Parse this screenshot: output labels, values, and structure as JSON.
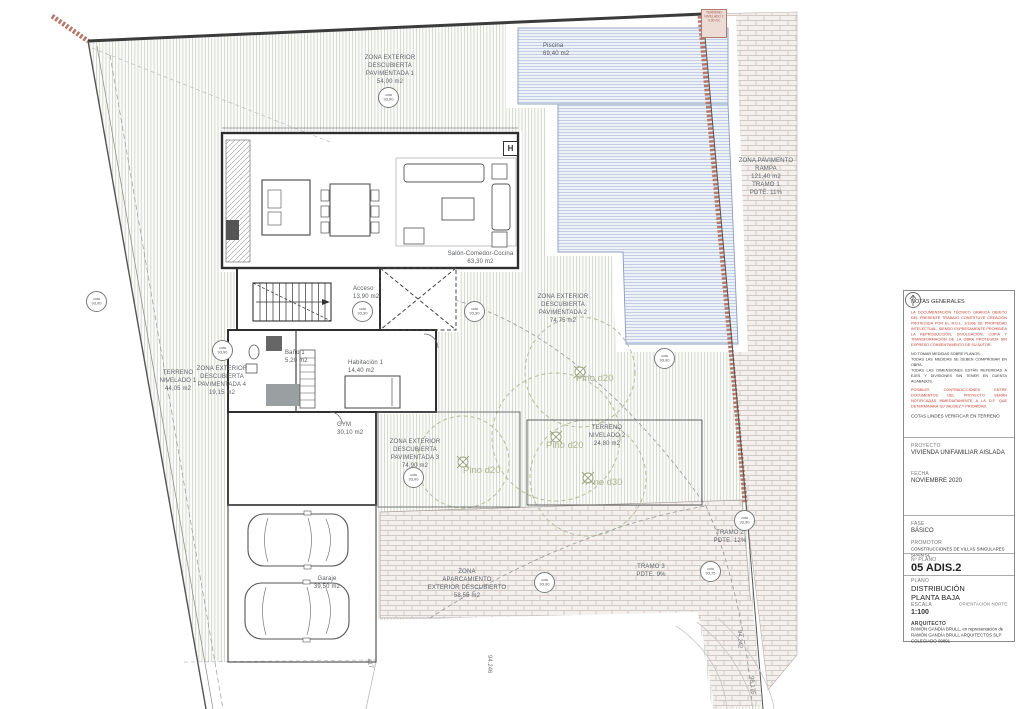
{
  "colors": {
    "terrain_hatch": "#ccd2c6",
    "pool_hatch": "#b9c6de",
    "brick": "#c9beb8",
    "retaining_wall": "#b5786a",
    "notes_red": "#c0392b",
    "tree_olive": "#b5bd9f"
  },
  "plan": {
    "piscina": "Piscina\n69,40 m2",
    "zona1": "ZONA EXTERIOR\nDESCUBIERTA\nPAVIMENTADA 1\n54,00 m2",
    "corner": "TERRENO\nNIVELADO 2\n9,90 m2",
    "rampa": "ZONA PAVIMENTO\nRAMPA\n121,40 m2\nTRAMO 1\nPDTE. 11%",
    "salon": "Salón-Comedor-Cocina\n63,30 m2",
    "acceso": "Acceso\n13,90 m2",
    "zona2": "ZONA EXTERIOR\nDESCUBIERTA\nPAVIMENTADA 2\n74,75 m2",
    "terreno1": "TERRENO\nNIVELADO 1\n44,05 m2",
    "zona4": "ZONA EXTERIOR\nDESCUBIERTA\nPAVIMENTADA 4\n19,15 m2",
    "bano": "Baño 1\n5,20 m2",
    "hab": "Habitación 1\n14,40 m2",
    "gym": "GYM\n30,10 m2",
    "zona3": "ZONA EXTERIOR\nDESCUBIERTA\nPAVIMENTADA 3\n74,90 m2",
    "terreno2": "TERRENO\nNIVELADO 2\n24,80 m2",
    "garaje": "Garaje\n39,50 m2",
    "aparc": "ZONA\nAPARCAMIENTO\nEXTERIOR DESCUBIERTO\n58,55 m2",
    "tramo2": "TRAMO 2\nPDTE. 12%",
    "tramo3": "TRAMO 3\nPDTE. 9%",
    "p1": "Pino d20",
    "p2": "Pino d20",
    "p3": "Pino d20",
    "p4": "Pino d30",
    "h": "H",
    "m1": "94.246",
    "m2": "417",
    "m3": "94.242",
    "m4": "98.176",
    "cota_word": "cota",
    "cotas": {
      "c1": "93,90",
      "c2": "93,90",
      "c3": "93,90",
      "c4": "93,90",
      "c5": "93,90",
      "c6": "93,90",
      "c7": "93,90",
      "c8": "93,90",
      "c9": "93,90",
      "c10": "93,75"
    }
  },
  "titleblock": {
    "notes_title": "NOTAS GENERALES",
    "note_red1": "LA DOCUMENTACIÓN TÉCNICO GRÁFICA OBJETO DEL PRESENTE TRABAJO CONSTITUYE CREACIÓN PROTEGIDA POR EL R.D.L. 1/1996 DE PROPIEDAD INTELECTUAL, SIENDO EXPRESAMENTE PROHIBIDA LA REPRODUCCIÓN, DIVULGACIÓN, COPIA Y TRANSFORMACIÓN DE LA OBRA PROTEGIDA SIN EXPRESO CONSENTIMIENTO DE SU AUTOR.",
    "note_black": "NO TOMAR MEDIDAS SOBRE PLANOS.\nTODAS LAS MEDIDAS SE DEBEN COMPROBAR EN OBRA.\nTODAS LAS DIMENSIONES ESTÁN REFERIDAS A EJES Y DIVISIONES SIN TENER EN CUENTA ACABADOS.",
    "note_red2": "POSIBLES CONTRADICCIONES ENTRE DOCUMENTOS DEL PROYECTO SERÁN NOTIFICADAS INMEDIATAMENTE A LA D.F. QUE DETERMINARÁ SU VALIDEZ Y PRIORIDAD.",
    "note_final": "COTAS LINDES VERIFICAR EN TERRENO",
    "proyecto_label": "PROYECTO",
    "proyecto": "VIVIENDA UNIFAMILIAR AISLADA",
    "fecha_label": "FECHA",
    "fecha": "NOVIEMBRE 2020",
    "fase_label": "FASE",
    "fase": "BÁSICO",
    "promotor_label": "PROMOTOR",
    "promotor": "CONSTRUCCIONES DE VILLAS SINGULARES SPAIN SL",
    "nplano_label": "Nº PLANO",
    "nplano": "05 ADIS.2",
    "plano_label": "PLANO",
    "plano": "DISTRIBUCIÓN\nPLANTA BAJA",
    "escala_label": "ESCALA",
    "escala": "1:100",
    "orientacion_label": "ORIENTACIÓN NORTE",
    "arquitecto_label": "ARQUITECTO",
    "arquitecto": "RAMÓN GANDÍA BRULL, en representación de\nRAMÓN GANDÍA BRULL ARQUITECTOS SLP\nCOLEGIADO 09891"
  }
}
